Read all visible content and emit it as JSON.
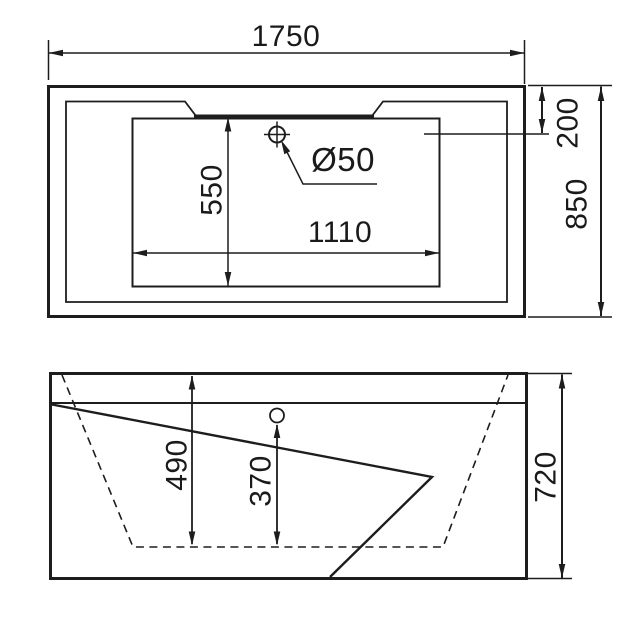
{
  "colors": {
    "line": "#1d1d1d",
    "background": "#ffffff"
  },
  "top_view": {
    "dim_overall_length": "1750",
    "dim_overall_width": "850",
    "dim_rim_to_basin": "200",
    "dim_basin_width": "550",
    "dim_basin_length": "1110",
    "drain_label": "Ø50"
  },
  "side_view": {
    "dim_overall_height": "720",
    "dim_inner_depth": "490",
    "dim_drain_depth": "370"
  }
}
